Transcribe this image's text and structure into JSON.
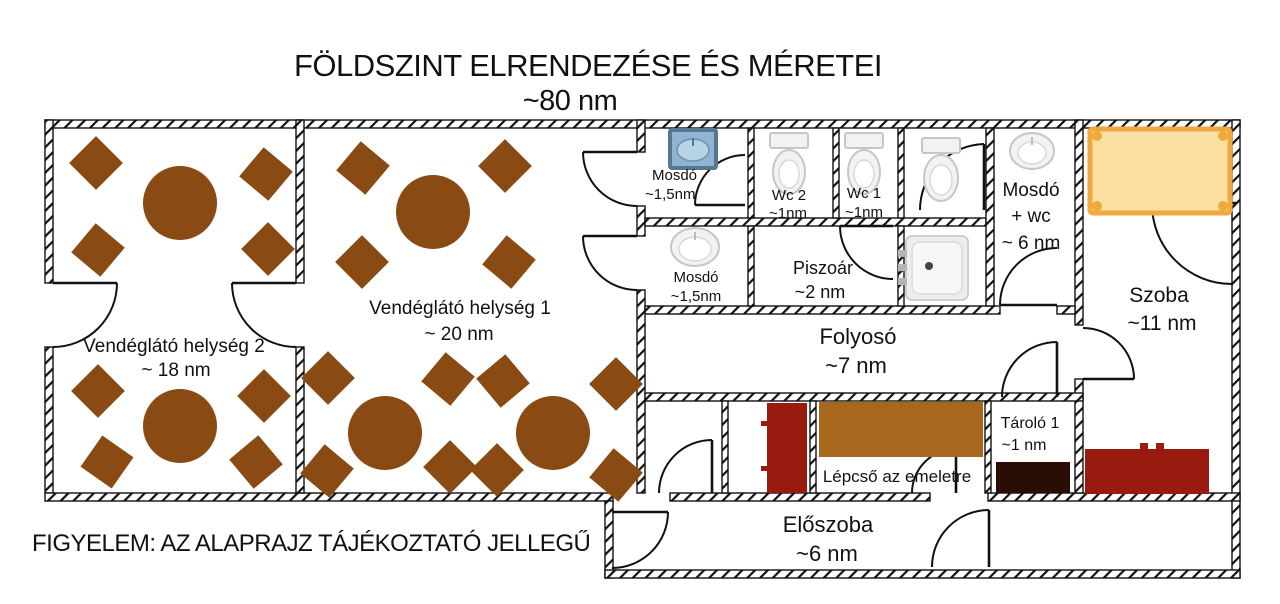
{
  "title": {
    "line1": "FÖLDSZINT ELRENDEZÉSE ÉS MÉRETEI",
    "line2": "~80 nm"
  },
  "footnote": "FIGYELEM: AZ ALAPRAJZ TÁJÉKOZTATÓ JELLEGŰ",
  "rooms": {
    "dining2": {
      "name": "Vendéglátó helység 2",
      "area": "~ 18 nm"
    },
    "dining1": {
      "name": "Vendéglátó helység 1",
      "area": "~ 20 nm"
    },
    "washroom_top": {
      "name": "Mosdó",
      "area": "~1,5nm"
    },
    "wc2": {
      "name": "Wc 2",
      "area": "~1nm"
    },
    "wc1": {
      "name": "Wc 1",
      "area": "~1nm"
    },
    "washroom_wc": {
      "line1": "Mosdó",
      "line2": "+ wc",
      "area": "~ 6 nm"
    },
    "washroom_mid": {
      "name": "Mosdó",
      "area": "~1,5nm"
    },
    "urinal": {
      "name": "Piszoár",
      "area": "~2 nm"
    },
    "corridor": {
      "name": "Folyosó",
      "area": "~7 nm"
    },
    "bedroom": {
      "name": "Szoba",
      "area": "~11 nm"
    },
    "storage": {
      "name": "Tároló 1",
      "area": "~1 nm"
    },
    "stairs": {
      "name": "Lépcső az emeletre"
    },
    "hallway": {
      "name": "Előszoba",
      "area": "~6 nm"
    }
  },
  "icon_names": [
    "round-table-icon",
    "chair-icon",
    "toilet-icon",
    "sink-icon",
    "blue-sink-icon",
    "shower-tray-icon",
    "bed-icon",
    "sofa-icon",
    "stairs-icon",
    "door-arc-icon",
    "radiator-icon",
    "storage-unit-icon"
  ],
  "colors": {
    "wood": "#8a4a13",
    "darkred": "#991b10",
    "stairs": "#a8671c",
    "storage": "#2a0e06",
    "bed": "#fbdfa3",
    "bedframe": "#efa93f",
    "bluesink": "#8fb4d4",
    "bluesinkborder": "#54788f",
    "fixture": "#f2f2f2",
    "fixtureborder": "#c6c6c6",
    "text": "#111111"
  }
}
